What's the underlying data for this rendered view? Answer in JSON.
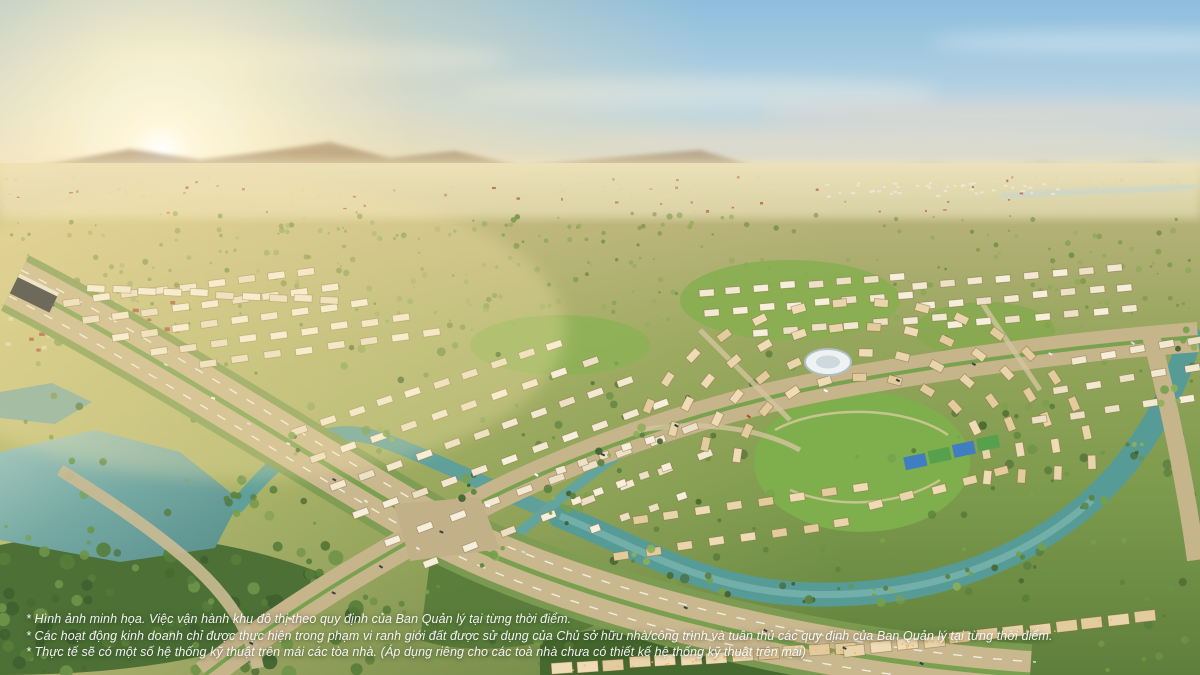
{
  "scene": {
    "title": "Aerial sunrise rendering of a master-planned township",
    "disclaimer": {
      "line1": "* Hình ảnh minh họa. Việc vận hành khu đô thị theo quy định của Ban Quản lý tại từng thời điểm.",
      "line2": "* Các hoạt động kinh doanh chỉ được thực hiện trong phạm vi ranh giới đất được sử dụng của Chủ sở hữu nhà/công trình và tuân thủ các quy định của Ban Quản lý tại từng thời điểm.",
      "line3": "* Thực tế sẽ có một số hệ thống kỹ thuật trên mái các tòa nhà. (Áp dụng riêng cho các toà nhà chưa có thiết kế hệ thống kỹ thuật trên mái)"
    },
    "palette": {
      "sky_blue": "#92c1de",
      "sun_glow": "#fff3cf",
      "horizon_haze": "#efe3bd",
      "field_green": "#8da556",
      "forest_green": "#4f7438",
      "water_teal": "#5fa09a",
      "road_beige": "#c9b78e",
      "house_cream": "#f2e9d2",
      "house_tan": "#e9d5ab",
      "roof_shadow": "#b3905f"
    }
  }
}
